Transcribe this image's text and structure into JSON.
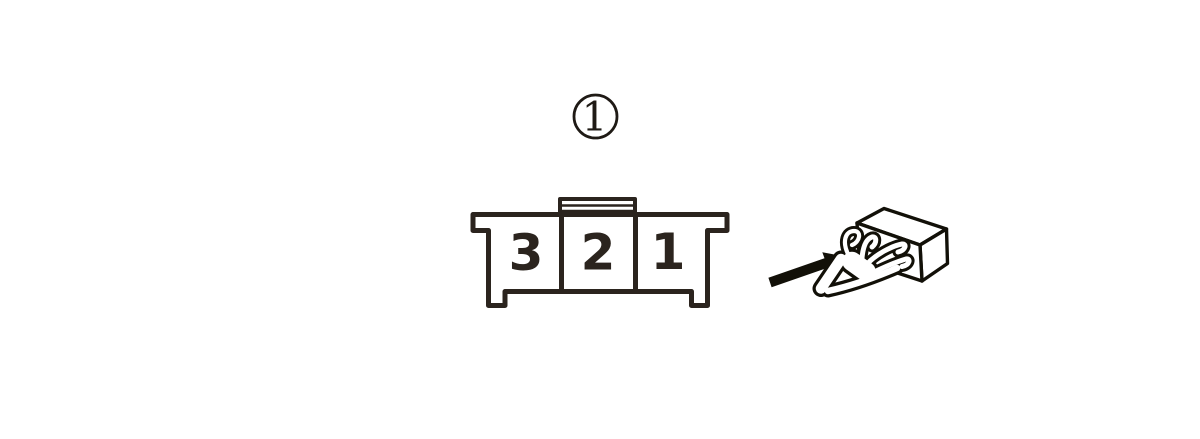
{
  "page": {
    "background": "#ffffff"
  },
  "figure": {
    "callout": {
      "label": "1"
    },
    "connector": {
      "pins": [
        "3",
        "2",
        "1"
      ]
    },
    "icons": {
      "arrow": "view-direction-arrow",
      "hand": "hand-holding-connector"
    },
    "colors": {
      "connector_line": "#2b241e",
      "callout_line": "#1f1a15",
      "icon_line": "#121008"
    }
  }
}
